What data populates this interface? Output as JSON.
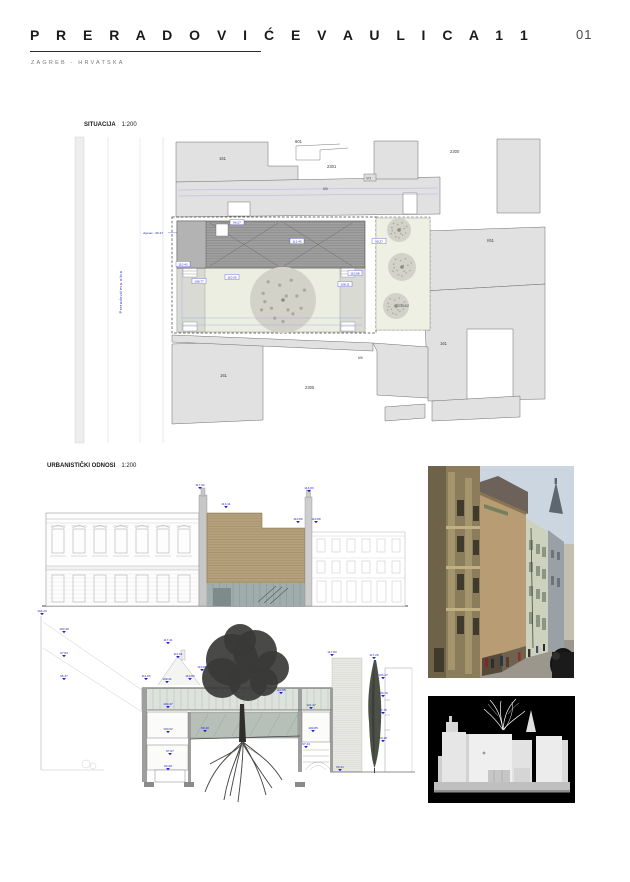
{
  "header": {
    "title": "P R E R A D O V I Ć E V A   U L I C A   1 1",
    "subtitle": "ZAGREB - HRVATSKA",
    "page_number": "01"
  },
  "site_plan": {
    "label": "SITUACIJA",
    "scale": "1:200",
    "street_name": "Preradovićeva ulica",
    "street_annotation": "vijenac - 96.27",
    "parcels": {
      "p161_nw": "161",
      "p601": "601",
      "p2301": "2301",
      "p_vo": "VO",
      "p65i": "65i",
      "p2300": "2300",
      "p_i61": "I/61",
      "p2304": "2304/2",
      "p161_e": "161",
      "p161_sw": "161",
      "p2305": "2305",
      "p65i_s": "65i"
    },
    "spot_elevations": [
      "96.27",
      "113.45",
      "110.43",
      "108.77",
      "110.00",
      "110.88",
      "108.11",
      "90.27"
    ]
  },
  "urban_section": {
    "label": "URBANISTIČKI ODNOSI",
    "scale": "1:200",
    "elevation_markers": [
      "117.92",
      "113.41",
      "113.83",
      "110.89",
      "110.88"
    ],
    "section_markers": [
      "104.23",
      "100.40",
      "97.83",
      "95.37",
      "117.41",
      "111.61",
      "110.87",
      "111.93",
      "109.41",
      "110.83",
      "110.85",
      "100.47",
      "96.40",
      "100.02",
      "97.67",
      "92.28",
      "100.85",
      "97.43",
      "101.47",
      "117.83",
      "117.26",
      "103.47",
      "100.16",
      "97.76",
      "93.18",
      "99.41"
    ]
  }
}
